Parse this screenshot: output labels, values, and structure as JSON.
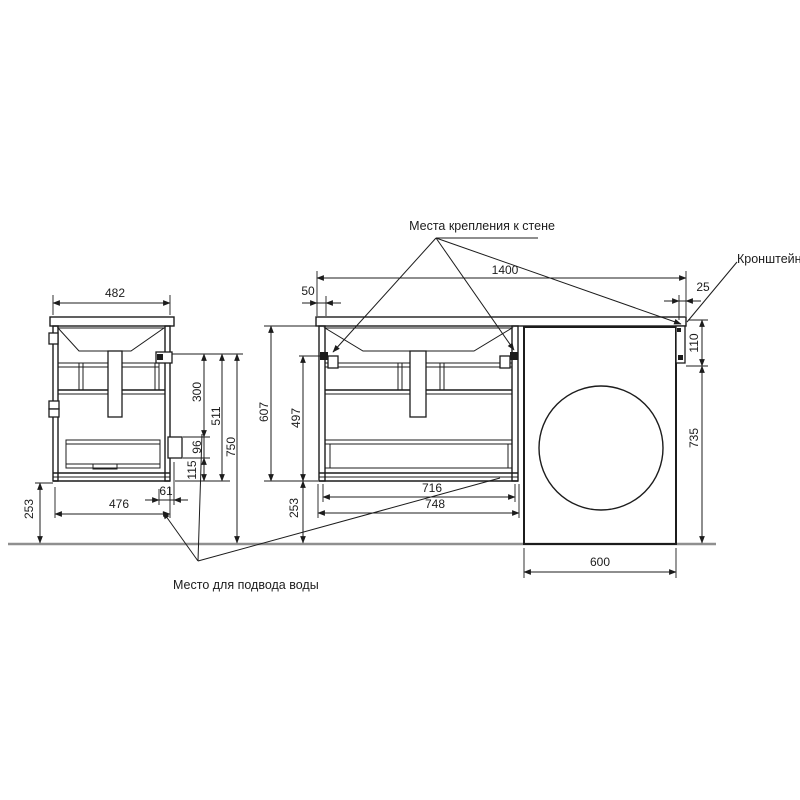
{
  "drawing": {
    "type": "technical-dimension-drawing",
    "subject": "vanity cabinet with washing machine",
    "language": "ru"
  },
  "colors": {
    "line": "#1c1c1c",
    "floor_line": "#8f8f8f",
    "background": "#ffffff"
  },
  "annotations": {
    "wall_mount_label": "Места крепления к стене",
    "bracket_label": "Кронштейн",
    "water_supply_label": "Место для подвода воды"
  },
  "side_view": {
    "width": "482",
    "base_width": "476",
    "bottom_to_floor": "253",
    "back_offset": "61",
    "mount_to_cutout": "300",
    "cutout_height": "96",
    "cutout_to_bottom": "115",
    "mount_to_bottom": "511",
    "mount_height": "750"
  },
  "front_view": {
    "total_width": "1400",
    "left_mount_offset": "50",
    "inner_height": "607",
    "mount_to_bottom": "497",
    "bottom_to_floor": "253",
    "inner_width": "716",
    "cabinet_width": "748"
  },
  "washer_zone": {
    "washer_width": "600",
    "bracket_clearance": "735",
    "bracket_offset": "25",
    "bracket_height": "110"
  }
}
